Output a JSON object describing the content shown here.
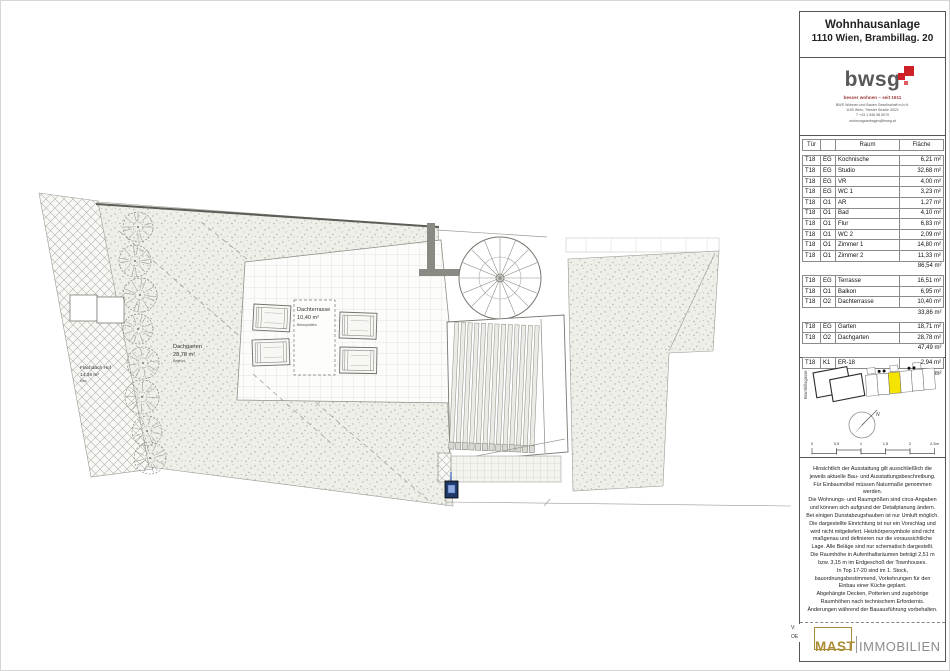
{
  "plan": {
    "labels": {
      "dachterrasse": {
        "name": "Dachterrasse",
        "area": "10,40 m²",
        "surface": "Betonplatten"
      },
      "dachgarten": {
        "name": "Dachgarten",
        "area": "28,78 m²",
        "surface": "Begrünt"
      },
      "flachdach": {
        "name": "Flachdach Hof",
        "area": "14,39 m²",
        "surface": "Kies"
      }
    }
  },
  "panel": {
    "header": {
      "title": "Wohnhausanlage",
      "subtitle": "1110 Wien, Brambillag. 20"
    },
    "logo": {
      "wordmark": "bwsg",
      "tagline": "besser wohnen – seit 1911",
      "company": "BWS Wohnen und Bauen Gesellschaft m.b.H.",
      "address": "1100 Wien, Triester Straße 40/21",
      "phone": "T +43 1 546 98 5070",
      "email": "wohnungsanfragen@bwsg.at",
      "brand_red": "#cd1f26",
      "brand_gray": "#58585a"
    },
    "room_table": {
      "headers": {
        "door": "Tür",
        "floor": "",
        "room": "Raum",
        "area": "Fläche"
      },
      "groups": [
        {
          "rows": [
            [
              "T18",
              "EG",
              "Kochnische",
              "6,21 m²"
            ],
            [
              "T18",
              "EG",
              "Studio",
              "32,68 m²"
            ],
            [
              "T18",
              "EG",
              "VR",
              "4,00 m²"
            ],
            [
              "T18",
              "EG",
              "WC 1",
              "3,23 m²"
            ],
            [
              "T18",
              "O1",
              "AR",
              "1,27 m²"
            ],
            [
              "T18",
              "O1",
              "Bad",
              "4,10 m²"
            ],
            [
              "T18",
              "O1",
              "Flur",
              "6,83 m²"
            ],
            [
              "T18",
              "O1",
              "WC 2",
              "2,09 m²"
            ],
            [
              "T18",
              "O1",
              "Zimmer 1",
              "14,80 m²"
            ],
            [
              "T18",
              "O1",
              "Zimmer 2",
              "11,33 m²"
            ]
          ],
          "subtotal": "86,54 m²"
        },
        {
          "rows": [
            [
              "T18",
              "EG",
              "Terrasse",
              "16,51 m²"
            ],
            [
              "T18",
              "O1",
              "Balkon",
              "6,95 m²"
            ],
            [
              "T18",
              "O2",
              "Dachterrasse",
              "10,40 m²"
            ]
          ],
          "subtotal": "33,86 m²"
        },
        {
          "rows": [
            [
              "T18",
              "EG",
              "Garten",
              "18,71 m²"
            ],
            [
              "T18",
              "O2",
              "Dachgarten",
              "28,78 m²"
            ]
          ],
          "subtotal": "47,49 m²"
        },
        {
          "rows": [
            [
              "T18",
              "K1",
              "ER-18",
              "2,94 m²"
            ]
          ],
          "subtotal": "2,94 m²"
        }
      ]
    },
    "site_plan": {
      "street_label": "Brambillagasse",
      "highlight_color": "#f5e400"
    },
    "compass": {
      "label": "N"
    },
    "scale_bar": {
      "labels": [
        "0",
        "0,5",
        "1",
        "1,5",
        "2",
        "2,5m"
      ]
    },
    "disclaimer": "Hinsichtlich der Ausstattung gilt ausschließlich die\njeweils aktuelle Bau- und Ausstattungsbeschreibung.\nFür Einbaumöbel müssen Naturmaße genommen\nwerden.\nDie Wohnungs- und Raumgrößen sind circa-Angaben\nund können sich aufgrund der Detailplanung ändern.\nBei einigen Dunstabzugshauben ist nur Umluft möglich.\nDie dargestellte Einrichtung ist nur ein Vorschlag und\nwird nicht mitgeliefert. Heizkörpersymbole sind nicht\nmaßgenau und definieren nur die voraussichtliche\nLage. Alle Beläge sind nur schematisch dargestellt.\nDie Raumhöhe in Aufenthaltsräumen beträgt 2,51 m\nbzw. 3,15 m im Erdgeschoß der Townhouses.\nIn Top 17-20 sind im 1. Stock,\nbauordnungsbestimmend, Vorkehrungen für den\nEinbau einer Küche geplant.\nAbgehängte Decken, Potterien und zugehörige\nRaumhöhen nach technischem Erfordernis.\nÄnderungen während der Bauausführung vorbehalten.",
    "footer": {
      "version_label": "V:",
      "revision_label": "OE",
      "brand_primary": "MAST",
      "brand_secondary": "IMMOBILIEN",
      "brand_gold": "#ab8d35",
      "brand_gray": "#8c8c8c"
    }
  }
}
